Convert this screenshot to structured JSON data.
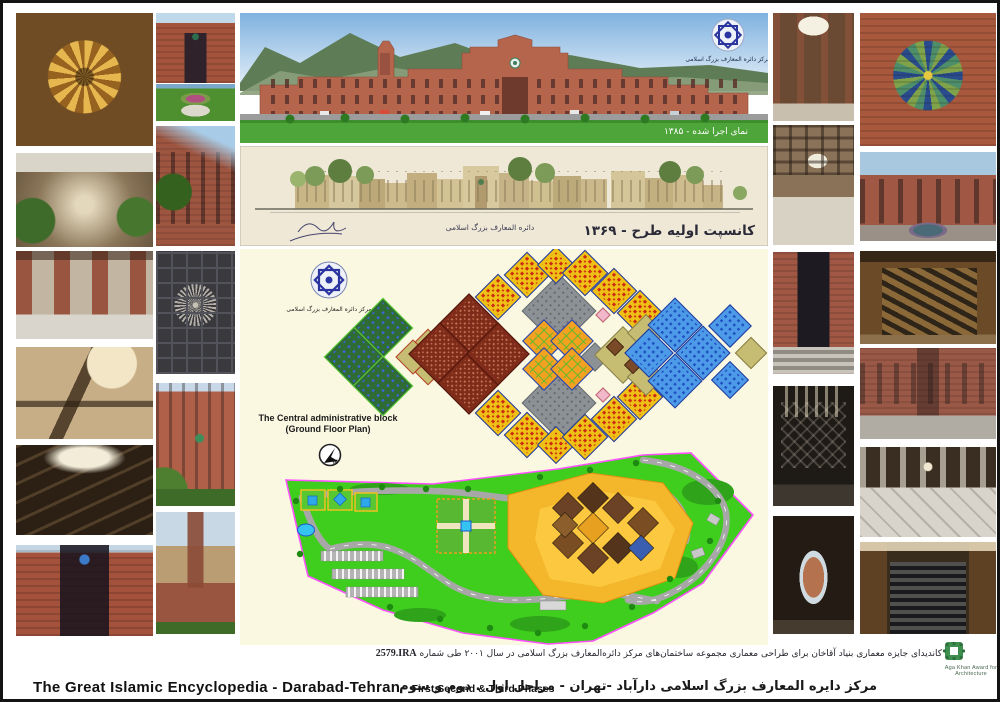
{
  "page": {
    "title_en_main": "The Great Islamic Encyclopedia - Darabad-Tehran-",
    "title_en_sub": "First,Second & Third Phases",
    "title_fa": "مرکز دایره المعارف بزرگ اسلامی دارآباد -تهران - مراحل اول . دوم و سوم",
    "candidacy_fa": "کاندیدای جایزه معماری بنیاد آقاخان برای طراحی معماری مجموعه ساختمان‌های مرکز دائره‌المعارف بزرگ اسلامی در سال ۲۰۰۱ طی شماره",
    "candidacy_number": "2579.IRA",
    "award_org": "Aga Khan Award for Architecture"
  },
  "panorama": {
    "caption_fa": "نمای اجرا شده - ۱۳۸۵",
    "logo_caption_fa": "مرکز دائره المعارف بزرگ اسلامی"
  },
  "elevation": {
    "caption_fa": "کانسپت اولیه طرح - ۱۳۶۹",
    "center_calligraphy_fa": "دائره المعارف بزرگ اسلامی"
  },
  "floor_plan": {
    "label_line1": "The Central administrative block",
    "label_line2": "(Ground Floor Plan)",
    "north_label": "N",
    "logo_caption_fa": "مرکز دائره المعارف بزرگ اسلامی",
    "colors": {
      "panel_cream": "#FBF8E2",
      "khaki": "#C6BC72",
      "maroon": "#7E2B1A",
      "yellow": "#EFC117",
      "orange": "#F2A120",
      "green": "#2F6B35",
      "blue": "#4D9BE8",
      "gray": "#8C9196"
    },
    "modules": [
      {
        "x": 143,
        "y": 79,
        "s": 21,
        "f": "#2F6B35",
        "p": "pgdots",
        "k": "#5ECC3A"
      },
      {
        "x": 114,
        "y": 108,
        "s": 21,
        "f": "#2F6B35",
        "p": "pgdots",
        "k": "#5ECC3A"
      },
      {
        "x": 143,
        "y": 137,
        "s": 21,
        "f": "#2F6B35",
        "p": "pgdots",
        "k": "#5ECC3A"
      },
      {
        "x": 173,
        "y": 108,
        "s": 12,
        "f": "#C6BC72",
        "k": "#B4482A"
      },
      {
        "x": 188,
        "y": 93,
        "s": 9,
        "f": "#C6BC72",
        "k": "#B4482A"
      },
      {
        "x": 188,
        "y": 123,
        "s": 9,
        "f": "#C6BC72",
        "k": "#B4482A"
      },
      {
        "x": 229,
        "y": 76,
        "s": 22,
        "f": "#7E2B1A",
        "p": "pmar",
        "k": "#50150A"
      },
      {
        "x": 200,
        "y": 105,
        "s": 22,
        "f": "#7E2B1A",
        "p": "pmar",
        "k": "#50150A"
      },
      {
        "x": 229,
        "y": 134,
        "s": 22,
        "f": "#7E2B1A",
        "p": "pmar",
        "k": "#50150A"
      },
      {
        "x": 258,
        "y": 105,
        "s": 22,
        "f": "#7E2B1A",
        "p": "pmar",
        "k": "#50150A"
      },
      {
        "x": 319,
        "y": 62,
        "s": 26,
        "f": "#8C9196",
        "p": "pgry",
        "k": "#686D72"
      },
      {
        "x": 319,
        "y": 154,
        "s": 26,
        "f": "#8C9196",
        "p": "pgry",
        "k": "#686D72"
      },
      {
        "x": 355,
        "y": 108,
        "s": 10,
        "f": "#8C9196",
        "k": "#686D72"
      },
      {
        "x": 304,
        "y": 92,
        "s": 15,
        "f": "#F2A120",
        "p": "pgrid",
        "k": "#2846AE"
      },
      {
        "x": 332,
        "y": 92,
        "s": 15,
        "f": "#F2A120",
        "p": "pgrid",
        "k": "#2846AE"
      },
      {
        "x": 304,
        "y": 120,
        "s": 15,
        "f": "#F2A120",
        "p": "pgrid",
        "k": "#2846AE"
      },
      {
        "x": 332,
        "y": 120,
        "s": 15,
        "f": "#F2A120",
        "p": "pgrid",
        "k": "#2846AE"
      },
      {
        "x": 258,
        "y": 48,
        "s": 16,
        "f": "#EFC117",
        "p": "pyel",
        "k": "#253A9E"
      },
      {
        "x": 287,
        "y": 26,
        "s": 16,
        "f": "#EFC117",
        "p": "pyel",
        "k": "#253A9E"
      },
      {
        "x": 316,
        "y": 16,
        "s": 13,
        "f": "#EFC117",
        "p": "pyel",
        "k": "#253A9E"
      },
      {
        "x": 345,
        "y": 24,
        "s": 16,
        "f": "#EFC117",
        "p": "pyel",
        "k": "#253A9E"
      },
      {
        "x": 374,
        "y": 42,
        "s": 16,
        "f": "#EFC117",
        "p": "pyel",
        "k": "#253A9E"
      },
      {
        "x": 400,
        "y": 64,
        "s": 16,
        "f": "#EFC117",
        "p": "pyel",
        "k": "#253A9E"
      },
      {
        "x": 258,
        "y": 164,
        "s": 16,
        "f": "#EFC117",
        "p": "pyel",
        "k": "#253A9E"
      },
      {
        "x": 287,
        "y": 186,
        "s": 16,
        "f": "#EFC117",
        "p": "pyel",
        "k": "#253A9E"
      },
      {
        "x": 316,
        "y": 196,
        "s": 13,
        "f": "#EFC117",
        "p": "pyel",
        "k": "#253A9E"
      },
      {
        "x": 345,
        "y": 188,
        "s": 16,
        "f": "#EFC117",
        "p": "pyel",
        "k": "#253A9E"
      },
      {
        "x": 374,
        "y": 170,
        "s": 16,
        "f": "#EFC117",
        "p": "pyel",
        "k": "#253A9E"
      },
      {
        "x": 400,
        "y": 148,
        "s": 16,
        "f": "#EFC117",
        "p": "pyel",
        "k": "#253A9E"
      },
      {
        "x": 383,
        "y": 106,
        "s": 20,
        "f": "#C6BC72",
        "k": "#8A8348"
      },
      {
        "x": 406,
        "y": 84,
        "s": 13,
        "f": "#C6BC72",
        "k": "#8A8348"
      },
      {
        "x": 406,
        "y": 128,
        "s": 13,
        "f": "#C6BC72",
        "k": "#8A8348"
      },
      {
        "x": 511,
        "y": 104,
        "s": 11,
        "f": "#C6BC72",
        "k": "#8A8348"
      },
      {
        "x": 375,
        "y": 98,
        "s": 6,
        "f": "#7A4A28",
        "k": "#4A2A12"
      },
      {
        "x": 393,
        "y": 116,
        "s": 6,
        "f": "#7A4A28",
        "k": "#4A2A12"
      },
      {
        "x": 363,
        "y": 66,
        "s": 5,
        "f": "#F0B8C8",
        "k": "#C06878"
      },
      {
        "x": 363,
        "y": 146,
        "s": 5,
        "f": "#F0B8C8",
        "k": "#C06878"
      },
      {
        "x": 435,
        "y": 76,
        "s": 19,
        "f": "#4D9BE8",
        "p": "pblu",
        "k": "#1E3C9E"
      },
      {
        "x": 409,
        "y": 104,
        "s": 17,
        "f": "#4D9BE8",
        "p": "pblu",
        "k": "#1E3C9E"
      },
      {
        "x": 435,
        "y": 132,
        "s": 19,
        "f": "#4D9BE8",
        "p": "pblu",
        "k": "#1E3C9E"
      },
      {
        "x": 463,
        "y": 104,
        "s": 19,
        "f": "#4D9BE8",
        "p": "pblu",
        "k": "#1E3C9E"
      },
      {
        "x": 490,
        "y": 77,
        "s": 15,
        "f": "#4D9BE8",
        "p": "pblu",
        "k": "#1E3C9E"
      },
      {
        "x": 490,
        "y": 131,
        "s": 13,
        "f": "#4D9BE8",
        "p": "pblu",
        "k": "#1E3C9E"
      }
    ]
  },
  "site_plan": {
    "colors": {
      "grass": "#3FCE1E",
      "boundary": "#FF50FF",
      "plaza": "#F4B62A",
      "road": "#A7A7A7",
      "pool": "#35C4F2"
    },
    "footprint": [
      {
        "x": 328,
        "y": 259,
        "s": 11,
        "f": "#6B4226"
      },
      {
        "x": 353,
        "y": 249,
        "s": 11,
        "f": "#54351C"
      },
      {
        "x": 378,
        "y": 259,
        "s": 11,
        "f": "#6B4226"
      },
      {
        "x": 403,
        "y": 274,
        "s": 11,
        "f": "#7A4E22"
      },
      {
        "x": 378,
        "y": 299,
        "s": 11,
        "f": "#54351C"
      },
      {
        "x": 353,
        "y": 309,
        "s": 11,
        "f": "#6B4226"
      },
      {
        "x": 328,
        "y": 294,
        "s": 11,
        "f": "#7A4E22"
      },
      {
        "x": 353,
        "y": 279,
        "s": 11,
        "f": "#E8A020"
      },
      {
        "x": 401,
        "y": 299,
        "s": 9,
        "f": "#3A5FB0"
      },
      {
        "x": 325,
        "y": 276,
        "s": 9,
        "f": "#8B5E2B"
      }
    ]
  },
  "photos": [
    {
      "name": "wood-rosette-ceiling-photo",
      "cls": "phA1"
    },
    {
      "name": "garden-corridor-photo",
      "cls": "phA2"
    },
    {
      "name": "atrium-lobby-photo",
      "cls": "phA3"
    },
    {
      "name": "ornate-staircase-photo",
      "cls": "phA4"
    },
    {
      "name": "stairwell-skylight-photo",
      "cls": "phA5"
    },
    {
      "name": "entrance-low-angle-photo",
      "cls": "phA6"
    },
    {
      "name": "brick-entrance-facade-photo",
      "cls": "phB1"
    },
    {
      "name": "flower-planter-photo",
      "cls": "phB2"
    },
    {
      "name": "brick-building-trees-photo",
      "cls": "phB3"
    },
    {
      "name": "coffered-ceiling-rosette-photo",
      "cls": "phB4"
    },
    {
      "name": "facade-emblem-photo",
      "cls": "phB5"
    },
    {
      "name": "tower-mountain-photo",
      "cls": "phB6"
    },
    {
      "name": "skylight-lobby-photo",
      "cls": "phC1"
    },
    {
      "name": "coffered-hall-photo",
      "cls": "phC2"
    },
    {
      "name": "marble-steps-entrance-photo",
      "cls": "phC3"
    },
    {
      "name": "metal-grille-interior-photo",
      "cls": "phC4"
    },
    {
      "name": "arched-courtyard-view-photo",
      "cls": "phC5"
    },
    {
      "name": "ceramic-tile-rosette-photo",
      "cls": "phD1"
    },
    {
      "name": "fountain-courtyard-facade-photo",
      "cls": "phD2"
    },
    {
      "name": "wooden-staircase-photo",
      "cls": "phD3"
    },
    {
      "name": "curved-brick-courtyard-photo",
      "cls": "phD4"
    },
    {
      "name": "marble-lobby-photo",
      "cls": "phD5"
    },
    {
      "name": "grand-staircase-photo",
      "cls": "phD6"
    }
  ]
}
